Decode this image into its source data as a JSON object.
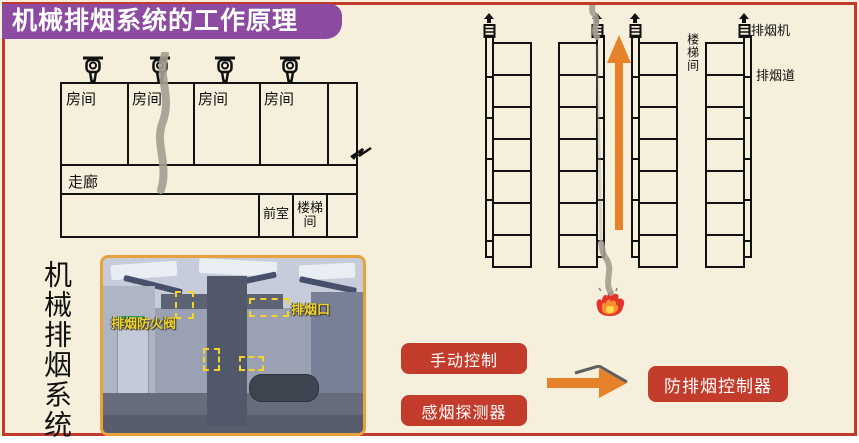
{
  "title": "机械排烟系统的工作原理",
  "colors": {
    "background": "#f6efdb",
    "frame_red": "#c13a2c",
    "banner_purple": "#8c4aa0",
    "accent_orange": "#e6832a",
    "box_red": "#c23b2b",
    "photo_border_orange": "#e9a23b",
    "annotation_yellow": "#f0d22b",
    "smoke_gray": "#a39d90"
  },
  "floor_plan": {
    "room_labels": [
      "房间",
      "房间",
      "房间",
      "房间"
    ],
    "corridor_label": "走廊",
    "front_room_label": "前室",
    "stairwell_label": "楼梯间"
  },
  "section_view": {
    "shaft_count": 4,
    "floors_per_shaft": 7,
    "stairwell_label": "楼梯间",
    "fan_label": "排烟机",
    "duct_label": "排烟道"
  },
  "photo": {
    "side_caption": "机械排烟系统",
    "damper_label": "排烟防火阀",
    "outlet_label": "排烟口"
  },
  "flow": {
    "inputs": [
      "手动控制",
      "感烟探测器"
    ],
    "output": "防排烟控制器"
  }
}
